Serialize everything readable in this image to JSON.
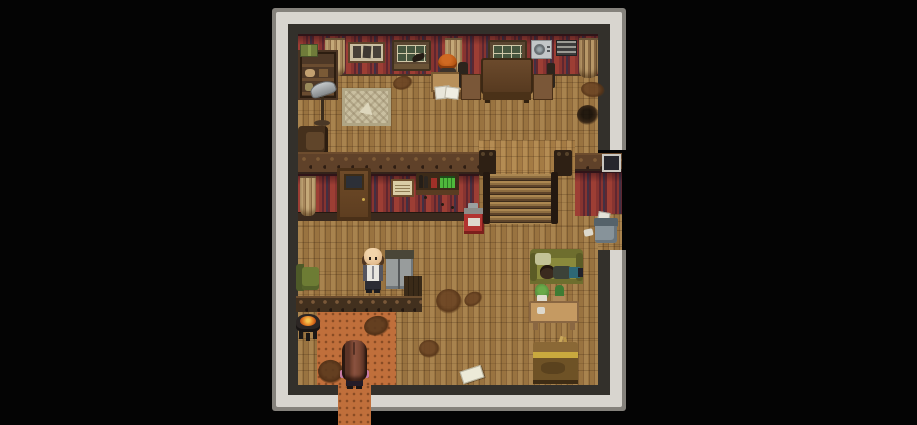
{
  "meta": {
    "domain": "game",
    "description": "Top-down pixel-art RPG interior (RPG Maker style): a wooden inn/saloon room with red striped wallpaper, plank floors, a staircase, a bar counter and an orange tiled entrance, letterboxed on black",
    "view": "overhead tile map"
  },
  "palette": {
    "bg": "#040404",
    "frame_gray": "#85827c",
    "frame_light": "#d8d5cf",
    "frame_dark": "#33302b",
    "wall_red": "#9d3e34",
    "wall_red_mid": "#873430",
    "wall_red_dark": "#5f2730",
    "wall_stripe_blue": "#433043",
    "floor_mid": "#997340",
    "floor_light": "#a8834e",
    "floor_dark": "#7e5d33",
    "trim_wood": "#5f4129",
    "wood_dark": "#3a2a1a",
    "tile_orange": "#c06f3b",
    "tile_orange_dark": "#9a5526",
    "couch_olive": "#8a8a3c",
    "fire": "#e07820",
    "bottle_green": "#4fb83c",
    "vending_red": "#b23430",
    "metal": "#98a0a2",
    "skin": "#e2bb8e"
  },
  "entities": {
    "player": {
      "label": "Player character with long auburn hair standing on the entrance tiles"
    },
    "clerk": {
      "label": "Bald man in a white shirt standing behind the counter"
    },
    "desk_npc": {
      "label": "Orange-haired person seated at a writing desk"
    },
    "sleeper": {
      "label": "Person napping on an olive couch"
    }
  },
  "objects": {
    "list": [
      "bookshelf with green kit box",
      "floor lamp",
      "woven rug",
      "framed triple picture",
      "window with bird silhouette",
      "second window",
      "air conditioner",
      "wall vent",
      "curtains",
      "large dining table with two chairs",
      "writing desk with papers",
      "interior door",
      "menu sign",
      "shelf with bottles",
      "red vending box",
      "staircase with newel posts",
      "bar counter",
      "gray cabinet",
      "green armchair",
      "charcoal brazier with fire",
      "olive couch",
      "plant table with potted plants",
      "wooden crate",
      "trash bin with paper",
      "dropped note",
      "floor stains",
      "floor hole",
      "side passage with red wall",
      "entrance tiles and exit path"
    ]
  }
}
